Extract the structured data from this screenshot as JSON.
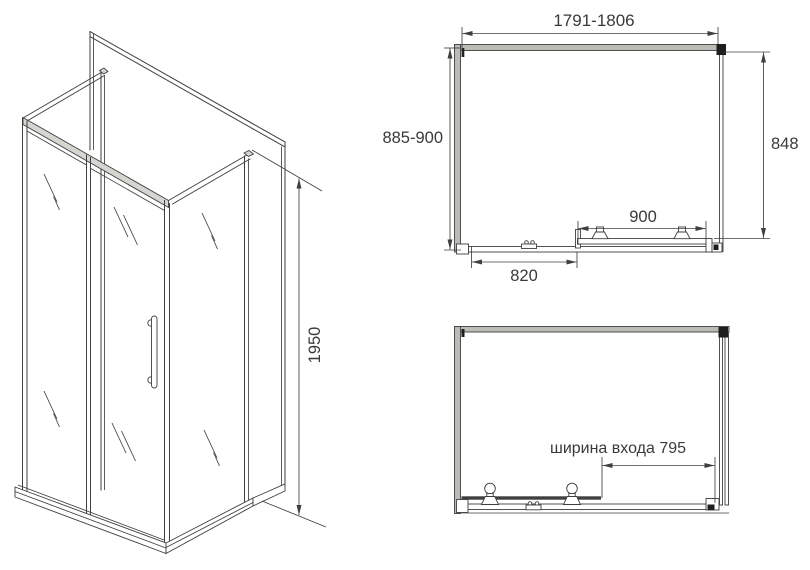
{
  "labels": {
    "iso_height": "1950",
    "overall_width": "1791-1806",
    "overall_depth": "885-900",
    "side_panel_width": "848",
    "door_section_width": "900",
    "fixed_section_width": "820",
    "entrance_width": "ширина входа 795"
  },
  "colors": {
    "line": "#3f3f3f",
    "text": "#3a3a3a",
    "frame_gray": "#bcbcb6",
    "highlight_dark": "#1e1e1e",
    "background": "#ffffff"
  }
}
